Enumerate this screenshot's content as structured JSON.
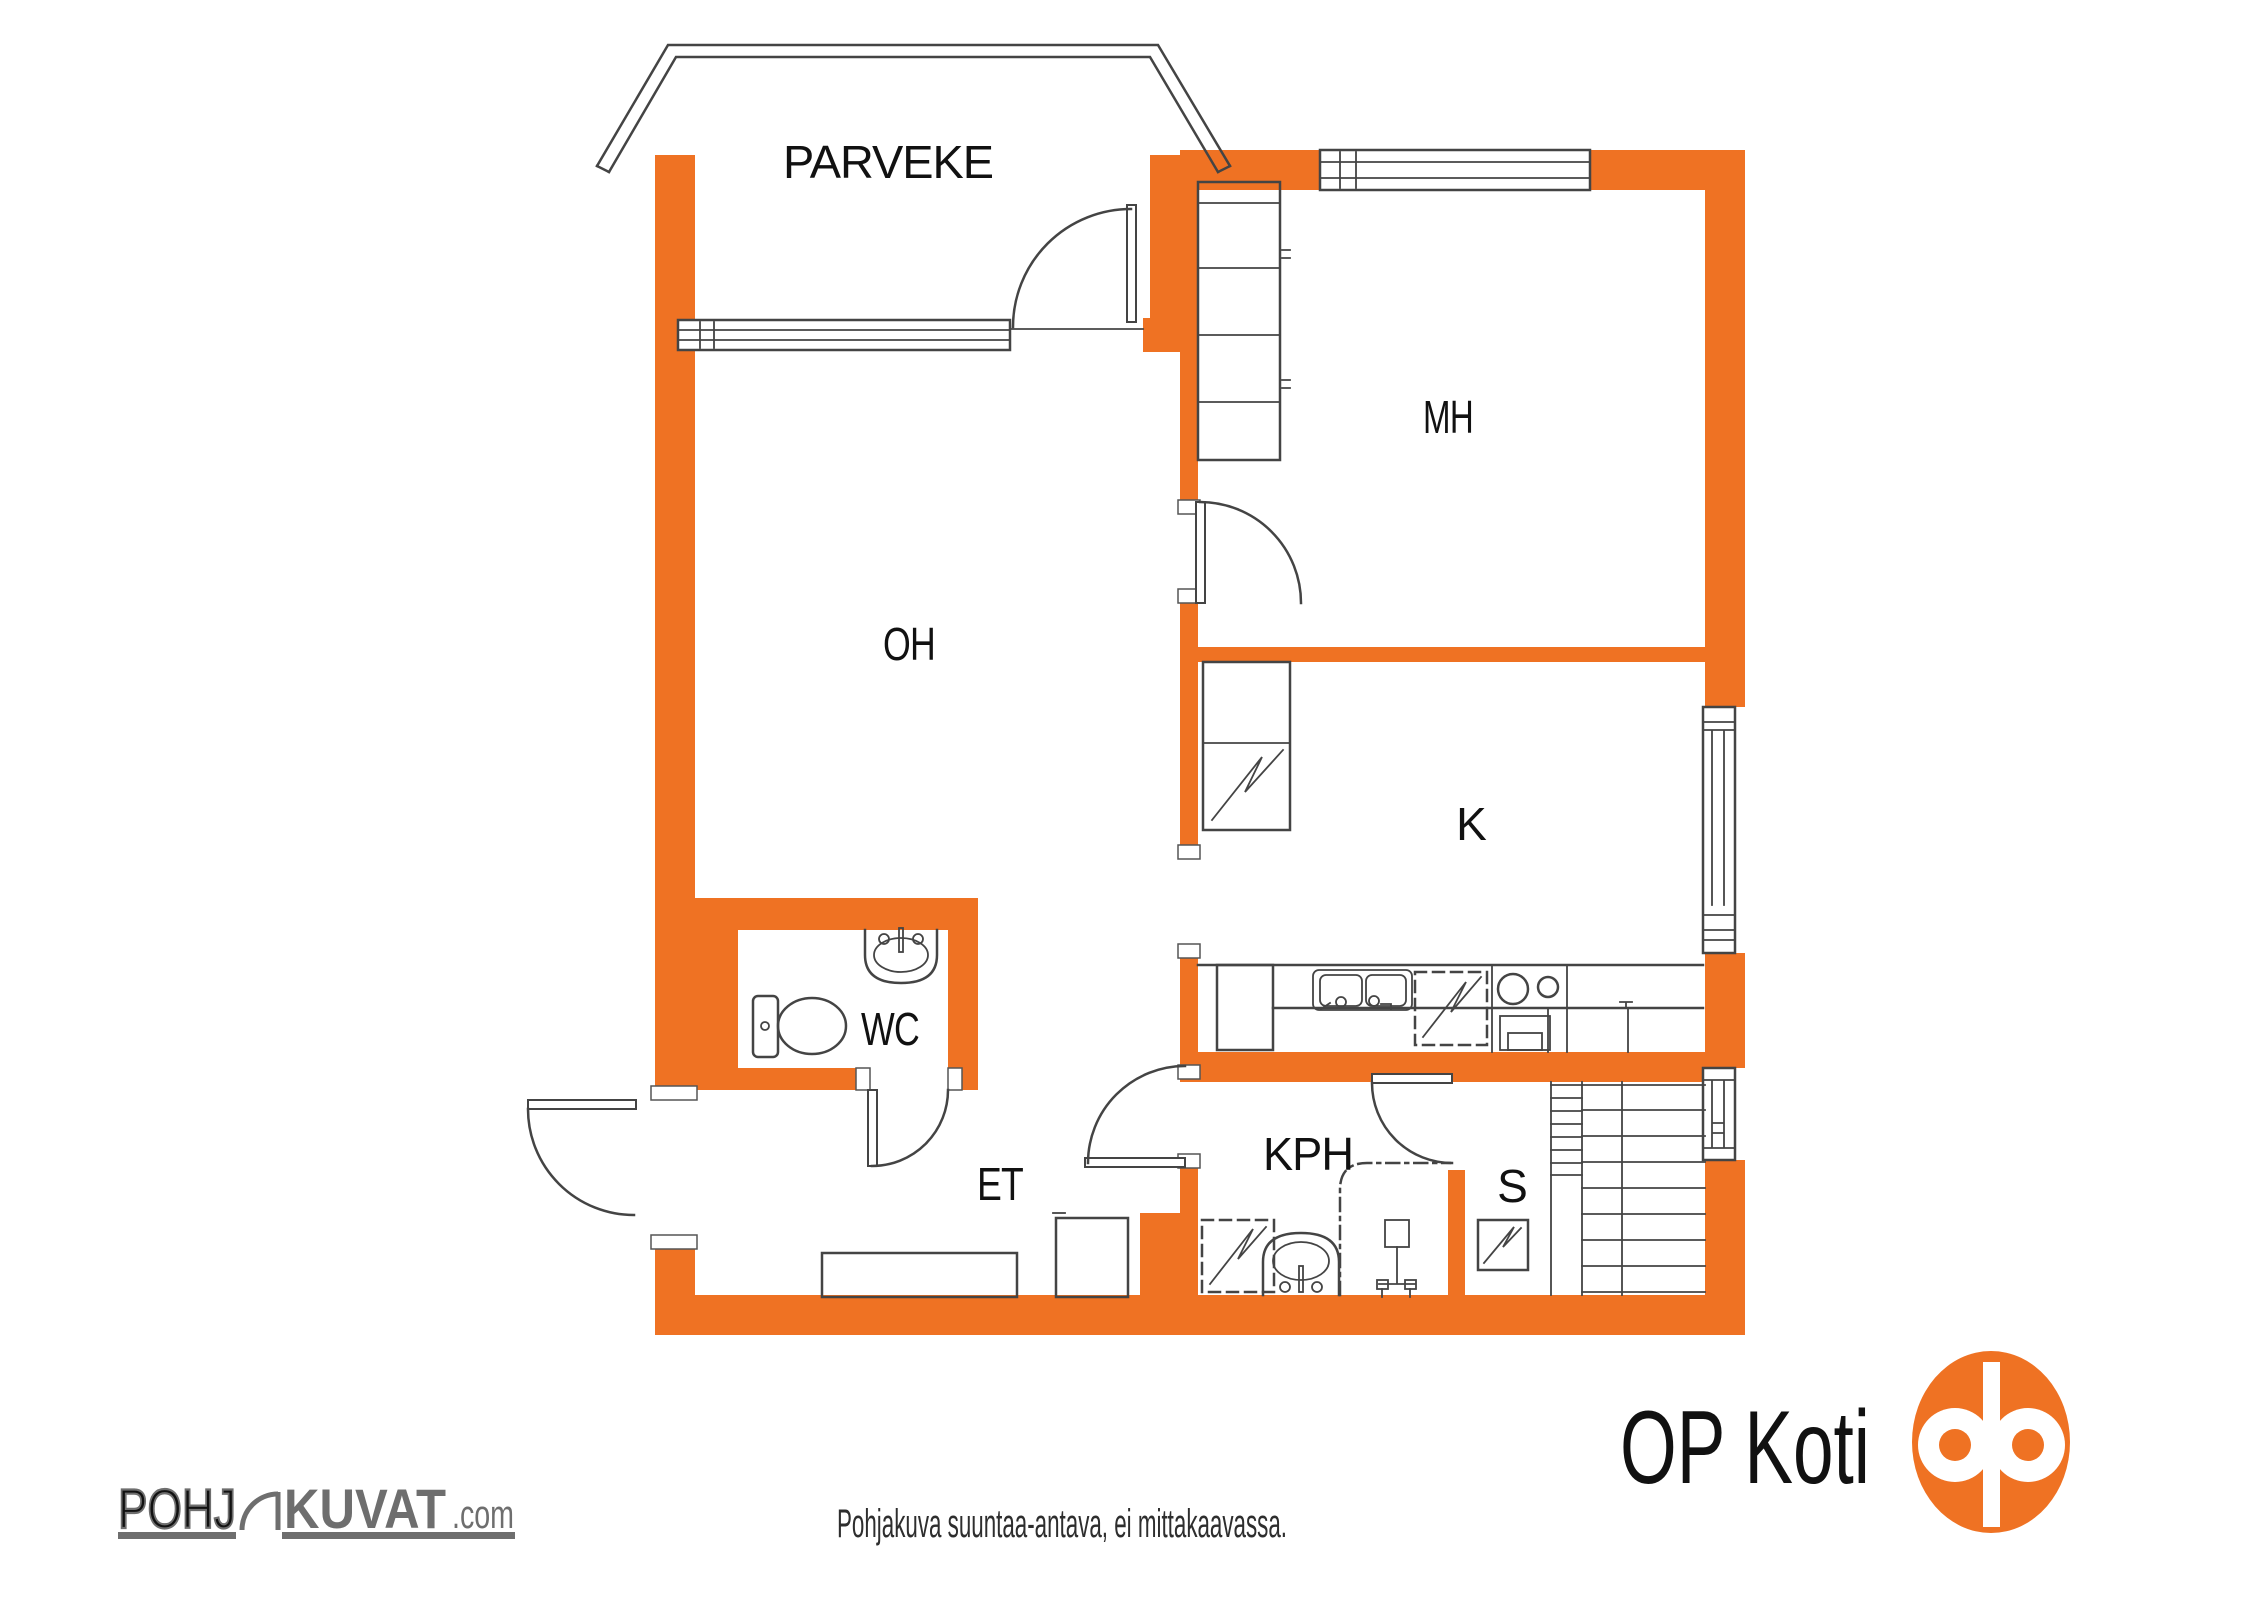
{
  "rooms": {
    "parveke": "PARVEKE",
    "mh": "MH",
    "oh": "OH",
    "k": "K",
    "wc": "WC",
    "et": "ET",
    "kph": "KPH",
    "s": "S"
  },
  "footer": {
    "disclaimer": "Pohjakuva suuntaa-antava, ei mittakaavassa."
  },
  "logos": {
    "pohjakuvat": {
      "part_outline": "POHJ",
      "part_solid": "KUVAT",
      "suffix": ".com"
    },
    "op_koti": {
      "label": "OP Koti"
    }
  },
  "colors": {
    "wall_orange": "#EF7223",
    "line_gray": "#444444",
    "logo_gray": "#6E6E6E",
    "op_orange": "#EF7223"
  }
}
